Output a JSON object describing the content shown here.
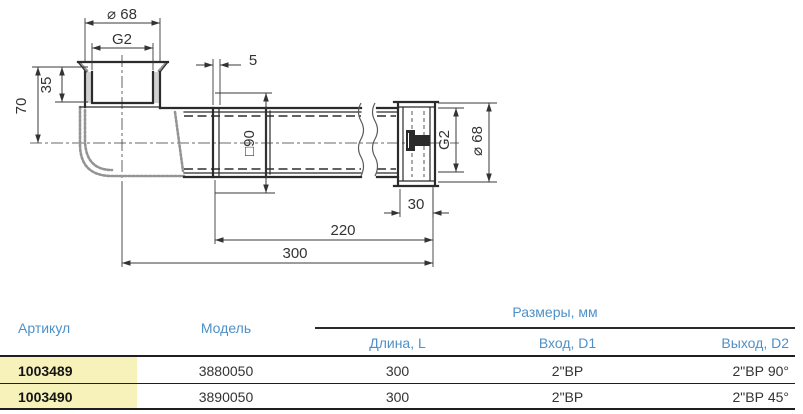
{
  "drawing": {
    "labels": {
      "top_outer_diameter": "⌀ 68",
      "top_thread": "G2",
      "socket_depth": "35",
      "elbow_height": "70",
      "flange_thickness": "5",
      "flange_square": "□90",
      "right_thread": "G2",
      "right_outer_diameter": "⌀ 68",
      "right_socket_length": "30",
      "pipe_length": "220",
      "total_length": "300"
    }
  },
  "table": {
    "headers": {
      "article": "Артикул",
      "model": "Модель",
      "sizes_group": "Размеры, мм",
      "length": "Длина, L",
      "inlet": "Вход, D1",
      "outlet": "Выход, D2"
    },
    "rows": [
      {
        "article": "1003489",
        "model": "3880050",
        "length": "300",
        "inlet": "2\"ВР",
        "outlet": "2\"ВР 90°"
      },
      {
        "article": "1003490",
        "model": "3890050",
        "length": "300",
        "inlet": "2\"ВР",
        "outlet": "2\"ВР 45°"
      }
    ],
    "colors": {
      "header_blue": "#4f90c7",
      "row_highlight_yellow": "#f7f2ba",
      "line_dark": "#1f1f1f",
      "value_text": "#333333"
    }
  }
}
